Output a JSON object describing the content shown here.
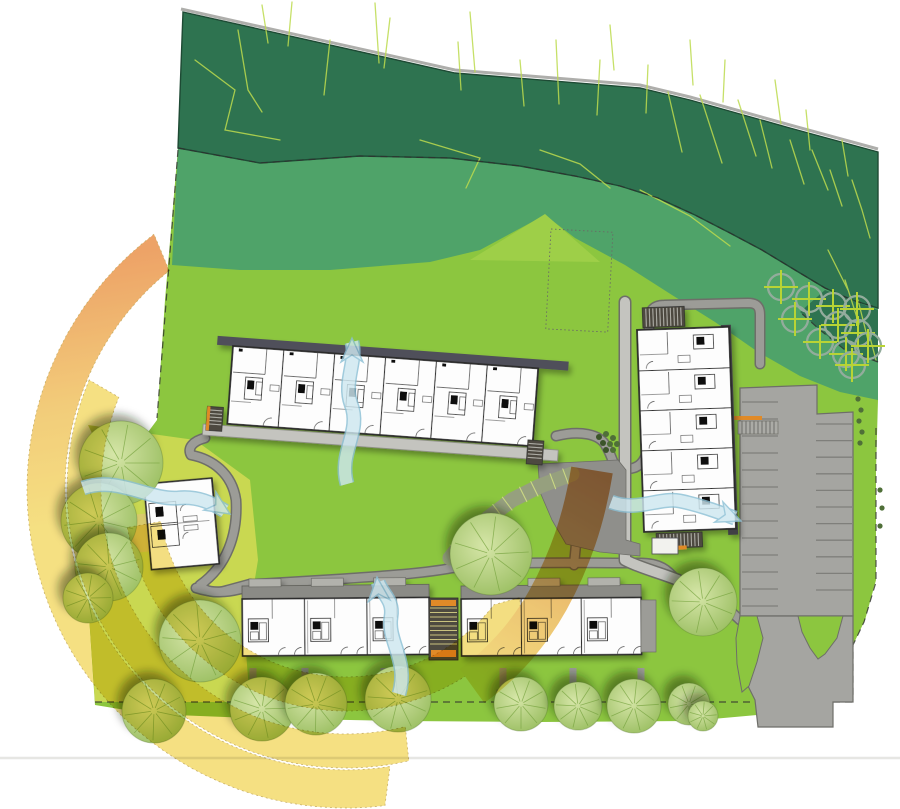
{
  "meta": {
    "label": "Residential development site plan with sun-path arcs, wind-flow arrows, housing blocks, parking and woodland"
  },
  "colors": {
    "background": "#ffffff",
    "forest": "#2E7350",
    "forest_edge": "#1E4A34",
    "hill": "#4FA369",
    "lawn": "#8CC63F",
    "lawn_wedge": "#9ECF48",
    "lawn_pale": "#C9D851",
    "sketch_line": "#BCDB4E",
    "path_fill": "#9C9C97",
    "path_edge": "#6E6E69",
    "walkway": "#C4C4BF",
    "plaza": "#8F8F8B",
    "ramp": "#96A07E",
    "ramp_tick": "#CBD884",
    "parking": "#A5A5A1",
    "parking_line": "#7F7F7B",
    "building_fill": "#FDFDFD",
    "building_wall": "#2B2B2B",
    "roof_band": "#50505A",
    "roof_band_dark": "#3F3F44",
    "yard_band": "#8B8B86",
    "yard_tab": "#B2B2AC",
    "stair_dark": "#4E4A40",
    "stair_tread": "#C9C27E",
    "accent_orange": "#E08A28",
    "tree_light": "#D6E6A8",
    "tree_mid": "#9CC063",
    "tree_line": "#74A13C",
    "orchard_ring": "#93AC9C",
    "orchard_cross": "#B8D435",
    "shrub": "#4F6F38",
    "sun_yellow": "#F2D75E",
    "sun_orange": "#E8893C",
    "sun_edge": "#B99A3F",
    "flow_blue_fill": "#CDE7F0",
    "flow_blue_edge": "#8CC0D5",
    "boundary_dash": "#2F2F2F",
    "street_line": "#E6E6E3",
    "terrace_tan": "#D9C96E"
  },
  "scene": {
    "trees": [
      [
        121,
        463,
        42
      ],
      [
        99,
        521,
        38
      ],
      [
        109,
        567,
        34
      ],
      [
        88,
        598,
        25
      ],
      [
        154,
        711,
        32
      ],
      [
        200,
        641,
        41
      ],
      [
        262,
        709,
        32
      ],
      [
        316,
        704,
        31
      ],
      [
        398,
        699,
        33
      ],
      [
        491,
        554,
        41
      ],
      [
        521,
        704,
        27
      ],
      [
        578,
        706,
        24
      ],
      [
        634,
        706,
        27
      ],
      [
        689,
        704,
        21
      ],
      [
        703,
        602,
        34
      ],
      [
        703,
        716,
        15
      ]
    ],
    "orchard_trees": [
      [
        781,
        287
      ],
      [
        809,
        299
      ],
      [
        833,
        306
      ],
      [
        857,
        309
      ],
      [
        795,
        319
      ],
      [
        838,
        325
      ],
      [
        858,
        333
      ],
      [
        820,
        342
      ],
      [
        846,
        354
      ],
      [
        868,
        346
      ],
      [
        852,
        365
      ]
    ],
    "shrubs_plaza": [
      [
        599,
        437
      ],
      [
        606,
        434
      ],
      [
        613,
        438
      ],
      [
        603,
        443
      ],
      [
        610,
        444
      ],
      [
        617,
        444
      ],
      [
        606,
        450
      ],
      [
        613,
        450
      ]
    ],
    "shrubs_edge": [
      [
        858,
        399
      ],
      [
        861,
        410
      ],
      [
        859,
        421
      ],
      [
        862,
        432
      ],
      [
        860,
        443
      ],
      [
        880,
        490
      ],
      [
        882,
        508
      ],
      [
        880,
        526
      ]
    ],
    "sun_arcs": {
      "center": [
        346,
        489
      ],
      "bands": [
        {
          "r": 300,
          "w": 38,
          "a1": 233,
          "a2": 81,
          "gradient": true,
          "tip": false
        },
        {
          "r": 262,
          "w": 34,
          "a1": 203,
          "a2": 76,
          "gradient": false,
          "tip": false
        },
        {
          "r": 205,
          "w": 34,
          "a1": 170,
          "a2": 38,
          "gradient": false,
          "tip": true
        }
      ]
    },
    "sun_ray": {
      "d": "M592,470 C584,520 570,560 548,600 C530,632 505,662 472,686",
      "width": 42
    },
    "wind_flows": [
      {
        "d": "M347,484 C338,452 362,432 351,404 C343,382 357,362 352,342",
        "head": [
          352,
          338,
          -90
        ]
      },
      {
        "d": "M83,488 C118,476 148,500 178,498 C198,496 212,503 225,511",
        "head": [
          230,
          514,
          33
        ]
      },
      {
        "d": "M611,502 C638,512 658,497 680,501 C700,505 718,512 735,518",
        "head": [
          741,
          521,
          22
        ]
      },
      {
        "d": "M399,694 C409,661 387,641 391,617 C394,600 382,594 378,582",
        "head": [
          377,
          577,
          -95
        ]
      }
    ],
    "parking": {
      "stripe_rows": [
        {
          "x1": 742,
          "x2": 778,
          "y0": 402,
          "n": 13,
          "dy": 17.0
        },
        {
          "x1": 816,
          "x2": 852,
          "y0": 424,
          "n": 11,
          "dy": 16.6
        }
      ]
    },
    "buildings": {
      "long_block": {
        "x": 233,
        "y": 346,
        "rot": 4.2,
        "w": 306,
        "h": 78,
        "units": 6
      },
      "north_block": {
        "x": 637,
        "y": 330,
        "rot": -2,
        "w": 92,
        "h": 202,
        "units": 5
      },
      "small_house": {
        "x": 144,
        "y": 484,
        "rot": -5,
        "w": 68,
        "h": 86
      },
      "row_block_west": {
        "x": 242,
        "y": 586,
        "rot": -0.5,
        "w": 187,
        "units": 3
      },
      "row_block_east": {
        "x": 461,
        "y": 586,
        "rot": -0.5,
        "w": 180,
        "units": 3
      }
    },
    "path_stubs": {
      "xs": [
        253,
        305,
        384,
        503,
        573,
        641
      ],
      "y0": 668,
      "y1": 690
    },
    "ramp": {
      "pts": [
        [
          572,
          474
        ],
        [
          540,
          486
        ],
        [
          512,
          500
        ],
        [
          488,
          518
        ],
        [
          466,
          538
        ],
        [
          450,
          558
        ]
      ]
    }
  }
}
